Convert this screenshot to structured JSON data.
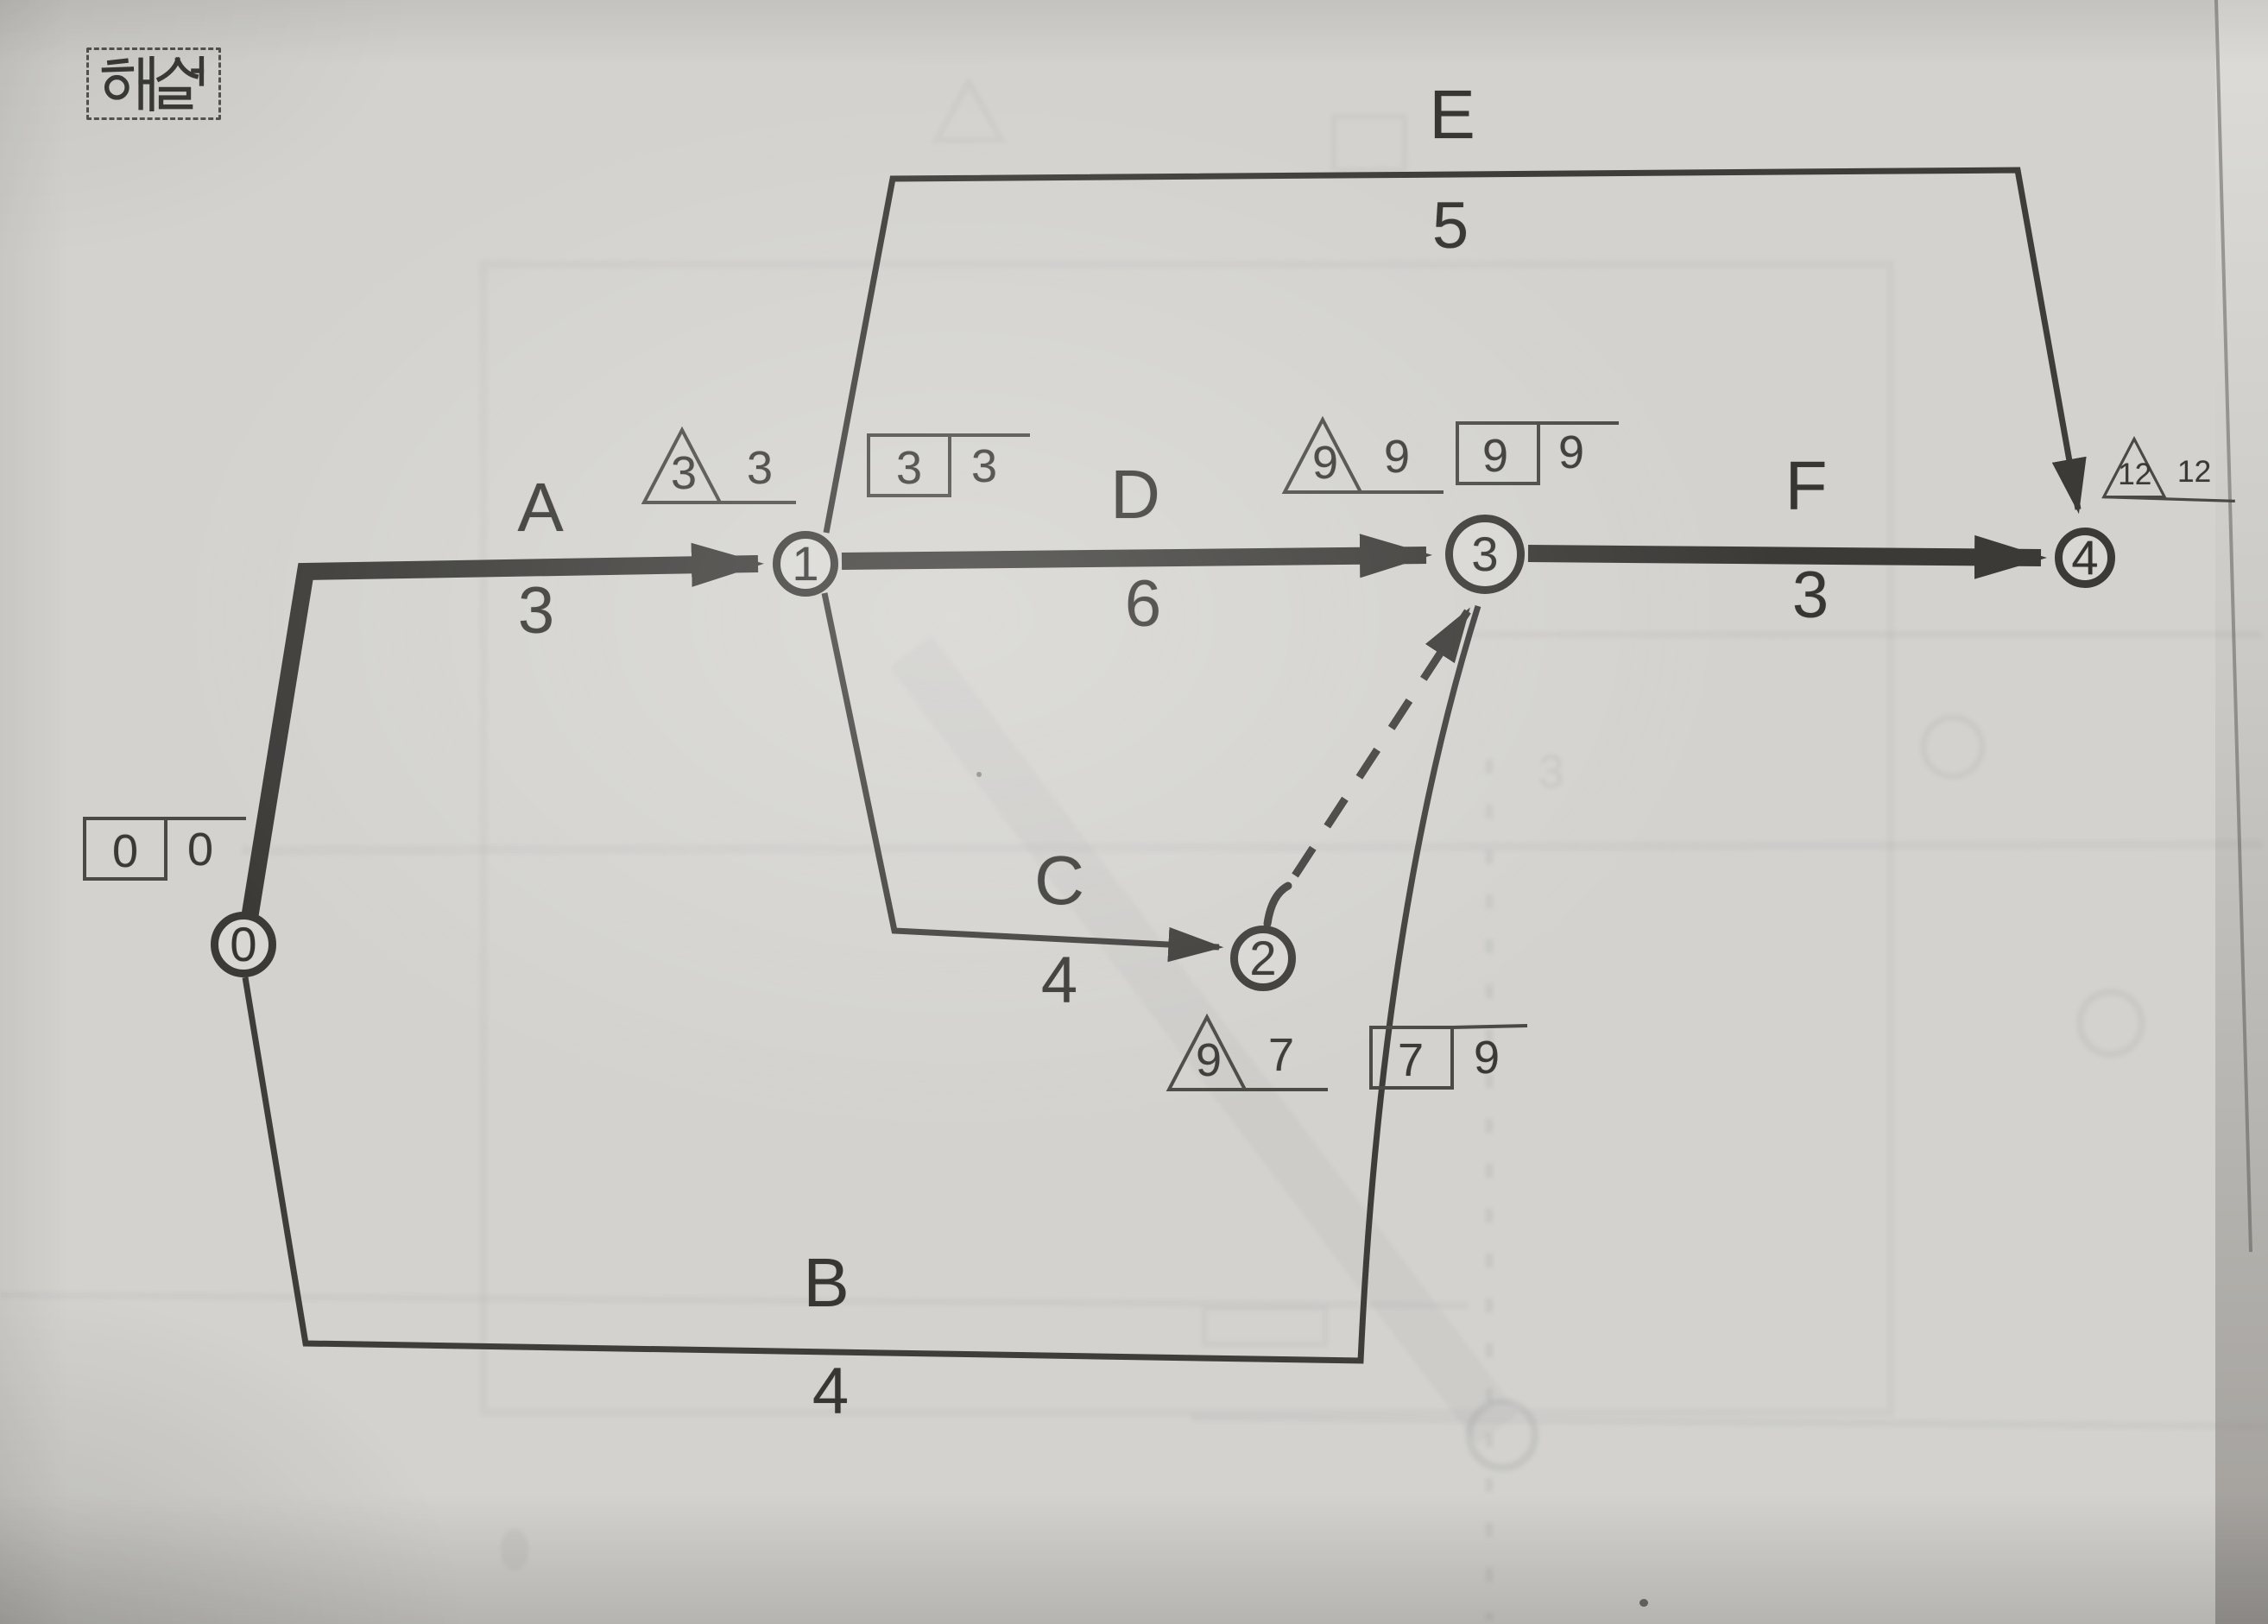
{
  "page": {
    "tag_label": "해설",
    "paper_color": "#d7d6d2",
    "ink_color": "#3b3a37"
  },
  "network": {
    "nodes": {
      "n0": {
        "label": "0"
      },
      "n1": {
        "label": "1"
      },
      "n2": {
        "label": "2"
      },
      "n3": {
        "label": "3"
      },
      "n4": {
        "label": "4"
      }
    },
    "edges": {
      "A": {
        "label": "A",
        "duration": "3",
        "from": "0",
        "to": "1",
        "critical": true,
        "style": "solid"
      },
      "B": {
        "label": "B",
        "duration": "4",
        "from": "0",
        "to": "3",
        "critical": false,
        "style": "solid"
      },
      "C": {
        "label": "C",
        "duration": "4",
        "from": "1",
        "to": "2",
        "critical": false,
        "style": "solid"
      },
      "D": {
        "label": "D",
        "duration": "6",
        "from": "1",
        "to": "3",
        "critical": true,
        "style": "solid"
      },
      "E": {
        "label": "E",
        "duration": "5",
        "from": "1",
        "to": "4",
        "critical": false,
        "style": "solid"
      },
      "F": {
        "label": "F",
        "duration": "3",
        "from": "3",
        "to": "4",
        "critical": true,
        "style": "solid"
      },
      "dummy": {
        "from": "2",
        "to": "3",
        "critical": false,
        "style": "dashed"
      }
    },
    "annotations": {
      "n0_box": {
        "shape": "box",
        "left": "0",
        "right": "0"
      },
      "n1_tri": {
        "shape": "triangle",
        "left": "3",
        "right": "3"
      },
      "n1_box": {
        "shape": "box",
        "left": "3",
        "right": "3"
      },
      "n2_tri": {
        "shape": "triangle",
        "left": "9",
        "right": "7"
      },
      "n2_box": {
        "shape": "box",
        "left": "7",
        "right": "9"
      },
      "n3_tri": {
        "shape": "triangle",
        "left": "9",
        "right": "9"
      },
      "n3_box": {
        "shape": "box",
        "left": "9",
        "right": "9"
      },
      "n4_tri": {
        "shape": "triangle",
        "left": "12",
        "right": "12"
      }
    }
  }
}
